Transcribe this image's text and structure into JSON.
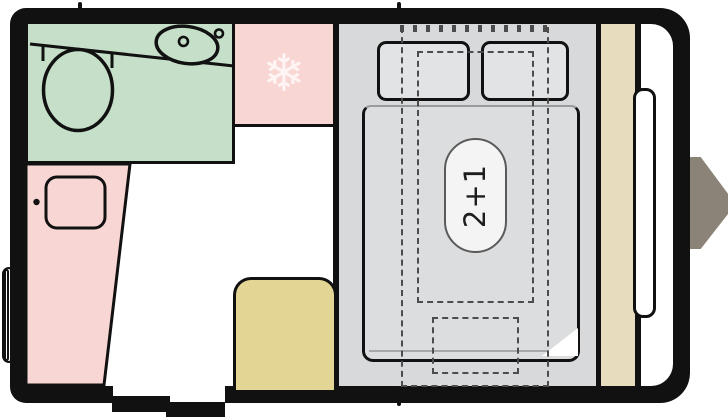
{
  "floorplan": {
    "bed_capacity_label": "2+1",
    "fridge_icon_glyph": "❄",
    "colors": {
      "wall_black": "#111111",
      "bathroom_green": "#c5dfc8",
      "furniture_pink": "#f8d6d3",
      "seat_tan": "#e3d593",
      "shelf_beige": "#e8dcbf",
      "bed_gray": "#d8d9da",
      "bedding_gray": "#dcddde",
      "hitch_gray": "#8b8377",
      "dash_gray": "#4c4c4c"
    }
  }
}
